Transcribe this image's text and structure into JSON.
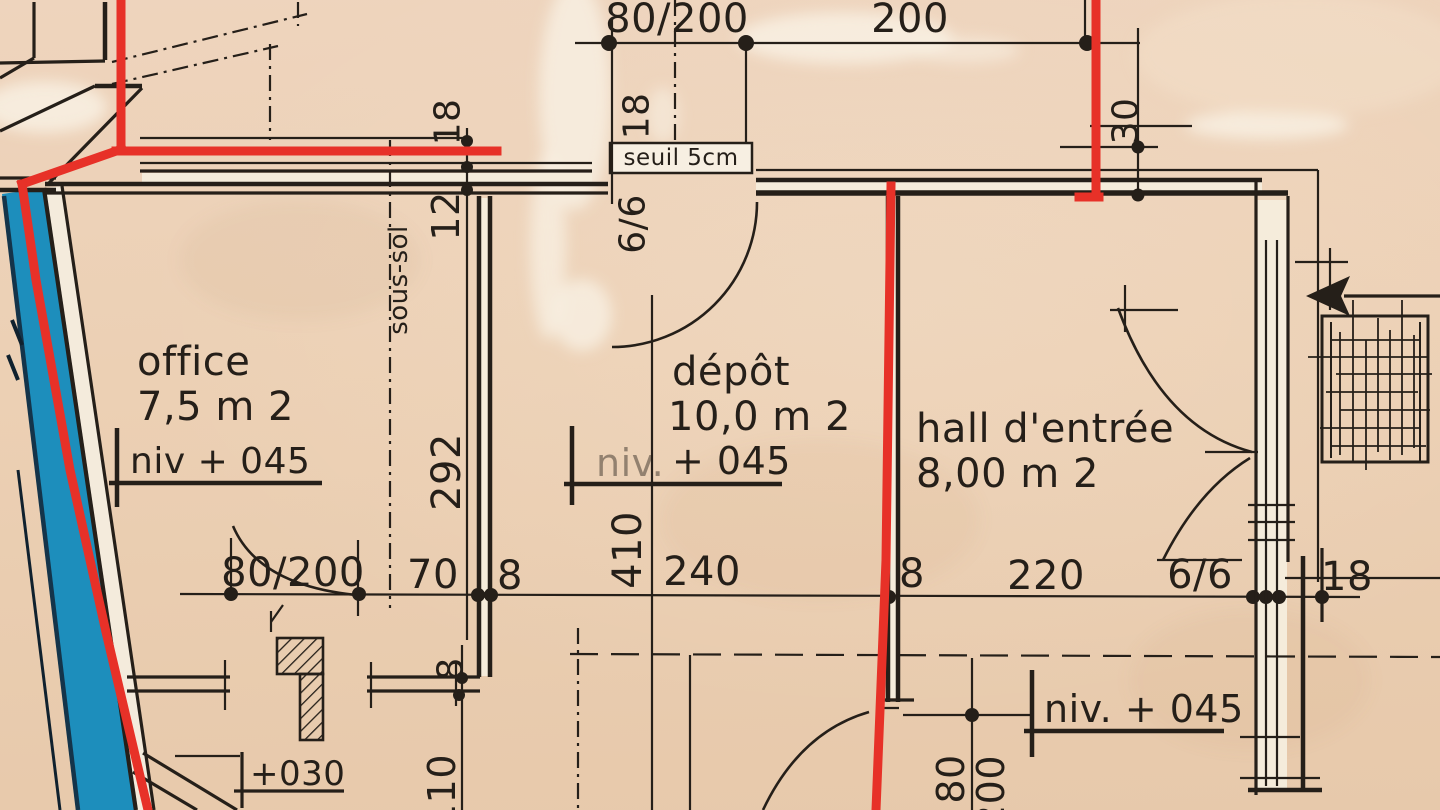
{
  "rooms": {
    "office": {
      "name": "office",
      "area": "7,5 m 2",
      "level": "niv + 045"
    },
    "depot": {
      "name": "dépôt",
      "area": "10,0 m 2",
      "level_prefix": "niv.",
      "level_value": "+ 045"
    },
    "hall": {
      "name": "hall d'entrée",
      "area": "8,00 m 2",
      "level": "niv. + 045"
    }
  },
  "annotations": {
    "threshold": "seuil 5cm",
    "basement": "sous-sol",
    "level_030": "+030"
  },
  "dims": {
    "top_door": "80/200",
    "top_width": "200",
    "top_wall_left": "18",
    "top_wall_mid": "18",
    "top_wall_right": "30",
    "mid_door": "80/200",
    "mid_70": "70",
    "mid_8_left": "8",
    "mid_240": "240",
    "mid_8_right": "8",
    "mid_220": "220",
    "mid_66": "6/6",
    "mid_18": "18",
    "v_12": "12",
    "v_66": "6/6",
    "v_292": "292",
    "v_410": "410",
    "v_8": "8",
    "v_110": "110",
    "v_80": "80",
    "v_200": "200"
  },
  "colors": {
    "paper": "#ecd0b4",
    "ink": "#251f19",
    "annotation_red": "#e73128",
    "water_blue": "#1d8ebc"
  }
}
